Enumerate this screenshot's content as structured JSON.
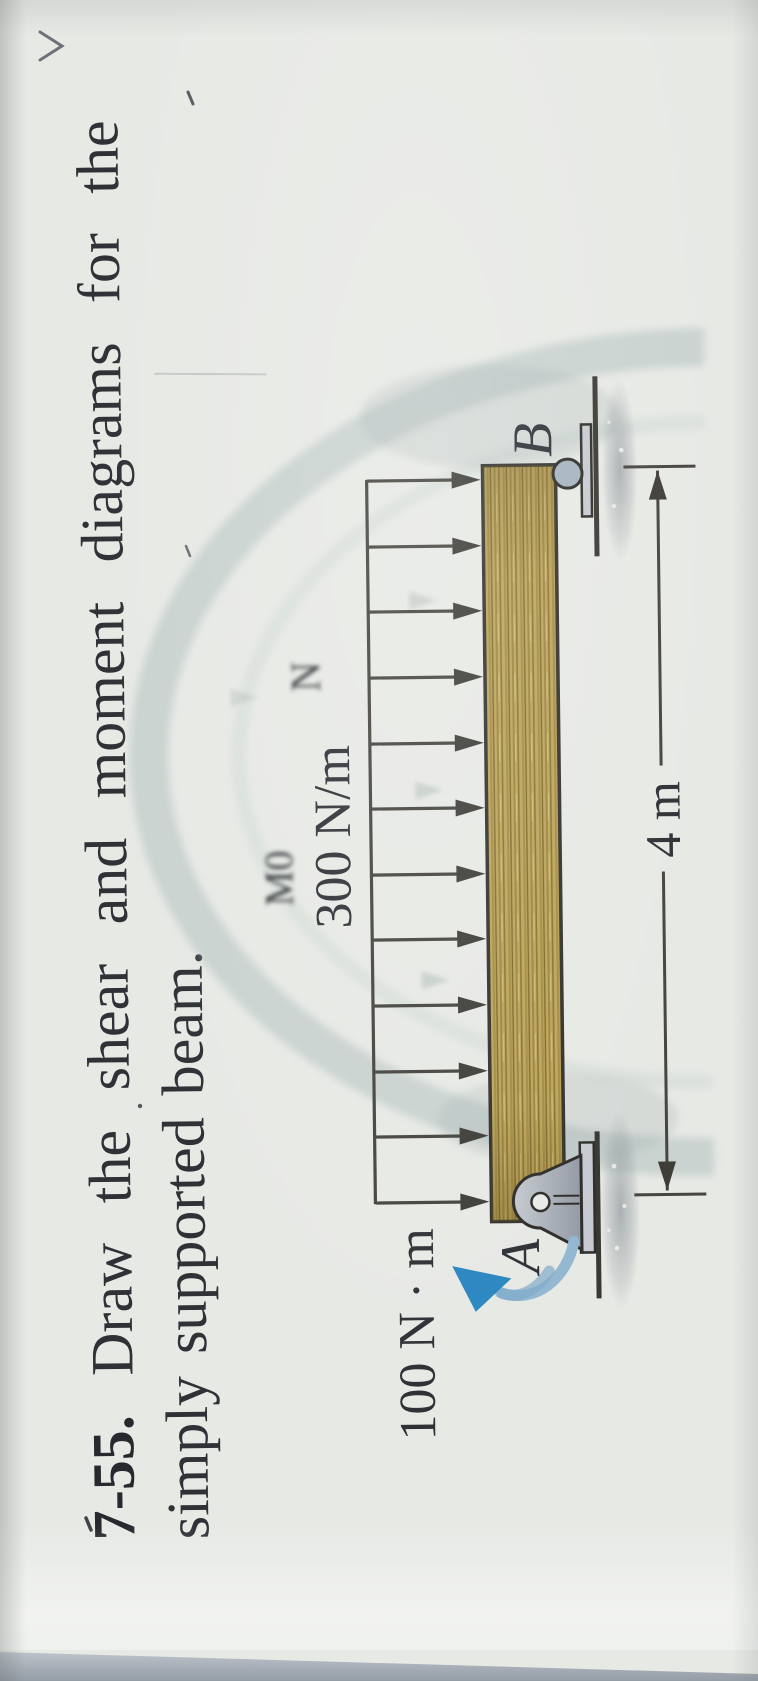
{
  "page": {
    "problem_number": "7-55.",
    "problem_line1_words": [
      "7-55.",
      "Draw",
      "the",
      "shear",
      "and",
      "moment",
      "diagrams",
      "for",
      "the"
    ],
    "problem_line2": "simply supported beam.",
    "problem_text": "Draw the shear and moment diagrams for the simply supported beam."
  },
  "figure": {
    "distributed_load_label": "300 N/m",
    "moment_label": "100 N · m",
    "support_a_label": "A",
    "support_b_label": "B",
    "dimension_label": "4 m",
    "load_arrow_count": 12,
    "support_a_type": "pin",
    "support_b_type": "roller",
    "ghost_mark_1": "M0",
    "ghost_mark_2": "N"
  },
  "colors": {
    "paper": "#e7e9e5",
    "ink": "#2e3237",
    "figure_line": "#44433d",
    "beam_fill": "#bda45a",
    "beam_outline": "#32312b",
    "support_gray": "#aeb4bc",
    "plate_gray": "#c7cbd1",
    "moment_blue": "#2b86c0",
    "moment_arc_blue": "#93b8d2",
    "desk": "#949ca6",
    "watermark": "#9eb4b2"
  }
}
